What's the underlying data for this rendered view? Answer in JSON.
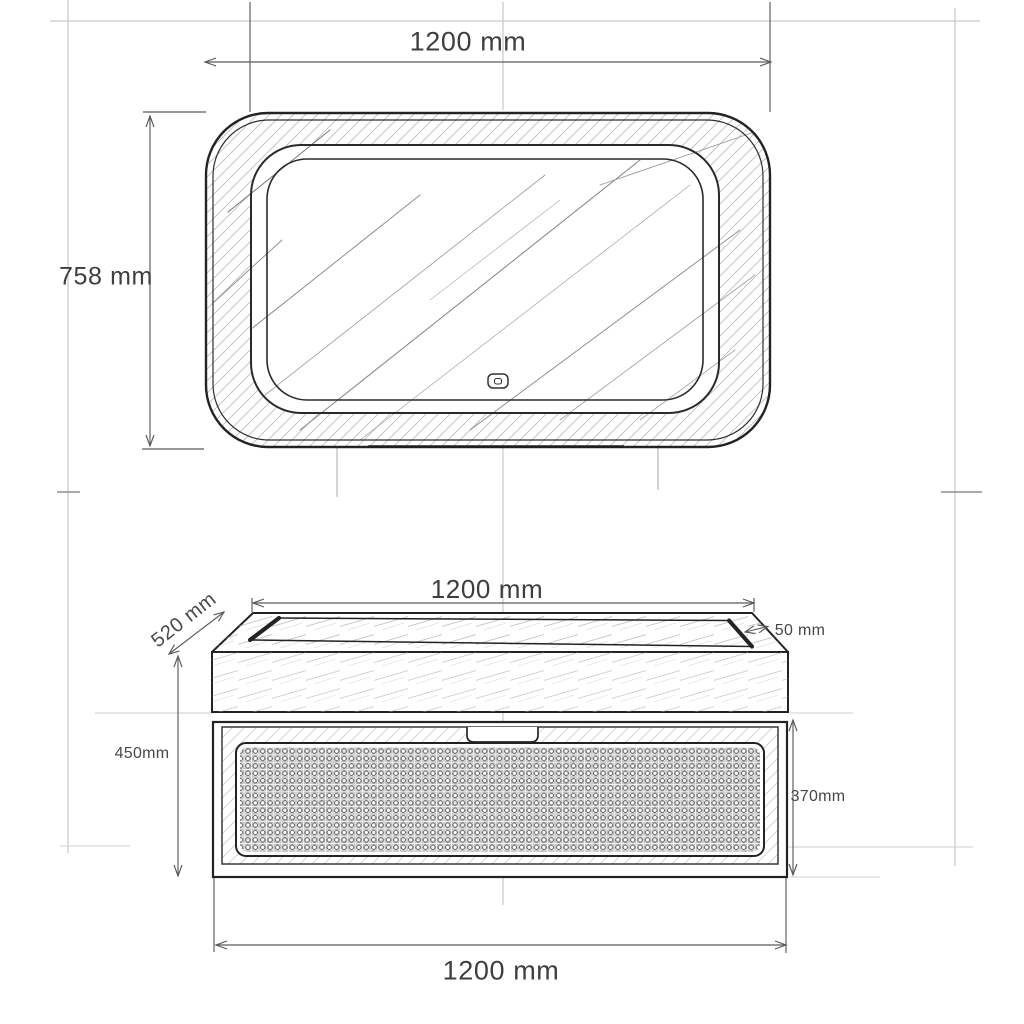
{
  "dimensions": {
    "mirror_width": "1200 mm",
    "mirror_height": "758 mm",
    "countertop_width": "1200 mm",
    "countertop_depth": "520 mm",
    "countertop_rim": "50 mm",
    "vanity_height": "450mm",
    "drawer_height": "370mm",
    "cabinet_width": "1200 mm"
  },
  "colors": {
    "line": "#232323",
    "dimension_line": "#5a5a5a",
    "construction_line": "#bdbdbd",
    "text": "#3e3e3e",
    "background": "#ffffff"
  },
  "icons": {
    "touch_sensor": "touch-sensor-icon"
  }
}
